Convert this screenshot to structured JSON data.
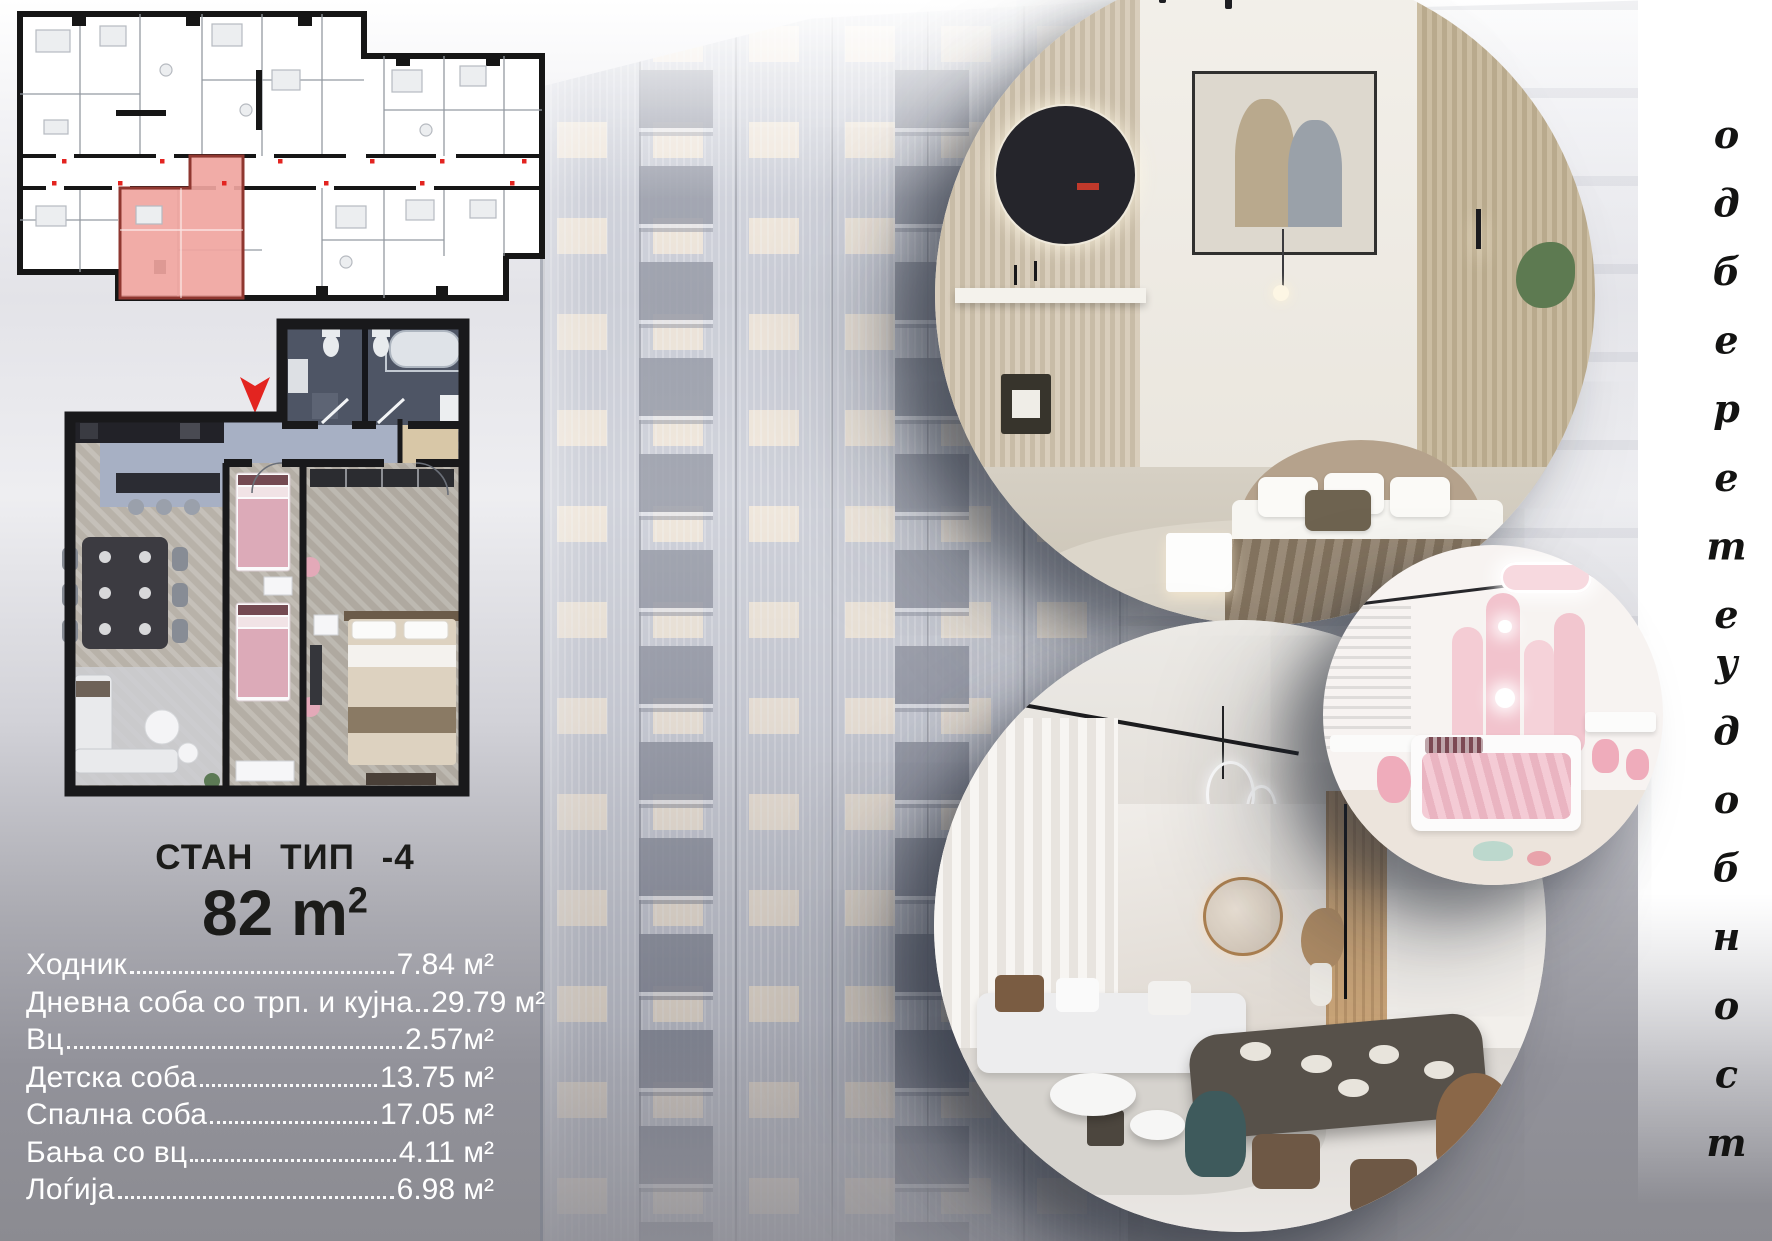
{
  "unit_card": {
    "type_label": "СТАН  ТИП -4",
    "area_value": "82 m",
    "area_superscript": "2",
    "rooms": [
      {
        "name": "Ходник",
        "area": "7.84 м²"
      },
      {
        "name": "Дневна соба со трп. и кујна",
        "area": "29.79 м²"
      },
      {
        "name": "Вц",
        "area": "2.57м²"
      },
      {
        "name": "Детска соба",
        "area": "13.75 м²"
      },
      {
        "name": "Спална соба",
        "area": "17.05 м²"
      },
      {
        "name": "Бања со вц",
        "area": "4.11 м²"
      },
      {
        "name": "Лоѓија",
        "area": "6.98 м²"
      }
    ]
  },
  "tagline": {
    "word1": "одберете",
    "word2": "удобност"
  },
  "colors": {
    "accent_red": "#e32420",
    "highlight_pink": "#f0a5a0",
    "list_text": "#ffffff",
    "title_text": "#1c1c1a"
  },
  "icons": {
    "location_arrow": "location-arrow-down"
  }
}
